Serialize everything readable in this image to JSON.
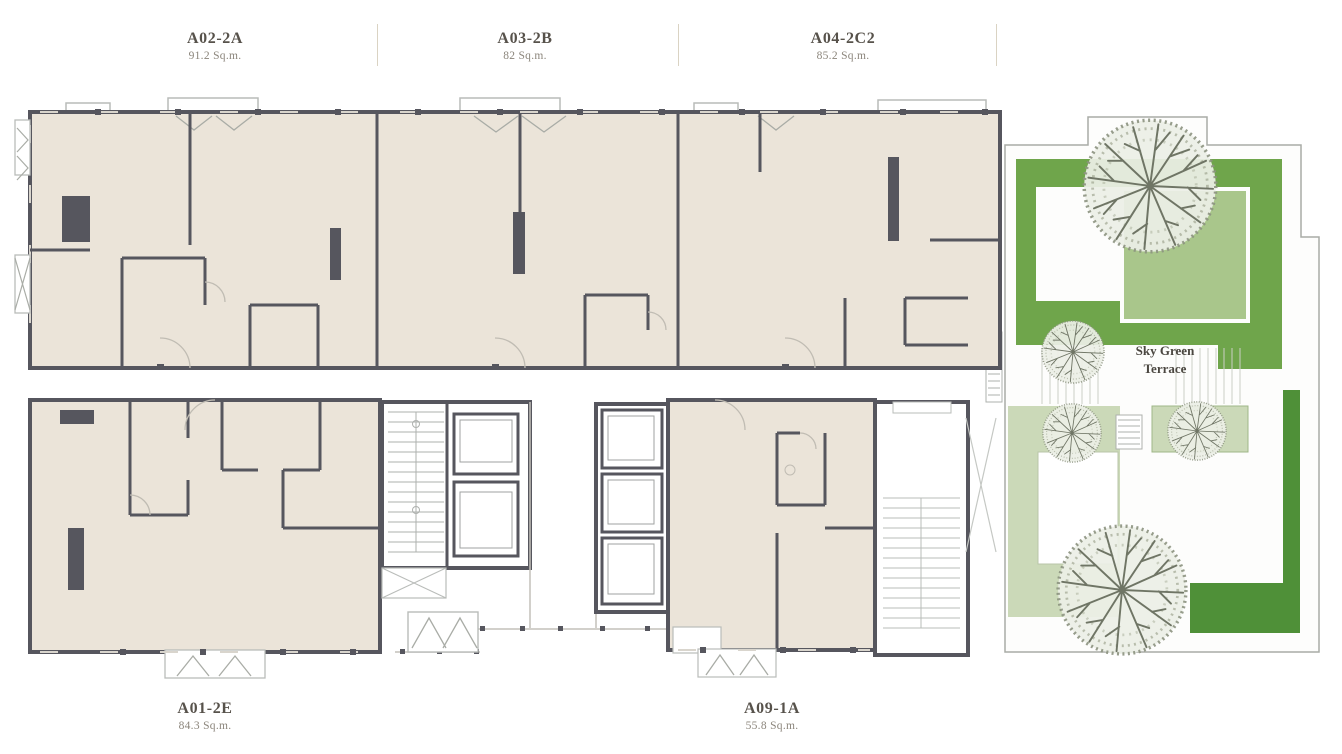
{
  "plan": {
    "units": [
      {
        "code": "A02-2A",
        "area": "91.2 Sq.m.",
        "wing": "top"
      },
      {
        "code": "A03-2B",
        "area": "82 Sq.m.",
        "wing": "top"
      },
      {
        "code": "A04-2C2",
        "area": "85.2 Sq.m.",
        "wing": "top"
      },
      {
        "code": "A01-2E",
        "area": "84.3 Sq.m.",
        "wing": "bottom"
      },
      {
        "code": "A09-1A",
        "area": "55.8 Sq.m.",
        "wing": "bottom"
      }
    ],
    "terrace": {
      "label": "Sky Green Terrace",
      "trees": 5
    },
    "icons": {
      "tree": "tree-plan-icon"
    },
    "colors": {
      "unit_fill": "#EBE4D9",
      "wall": "#56565E",
      "terrace_green": "#6FA54B",
      "terrace_green_dark": "#4F9038",
      "terrace_green_light": "#A9C68B",
      "terrace_green_pale": "#CBD9B8"
    }
  }
}
